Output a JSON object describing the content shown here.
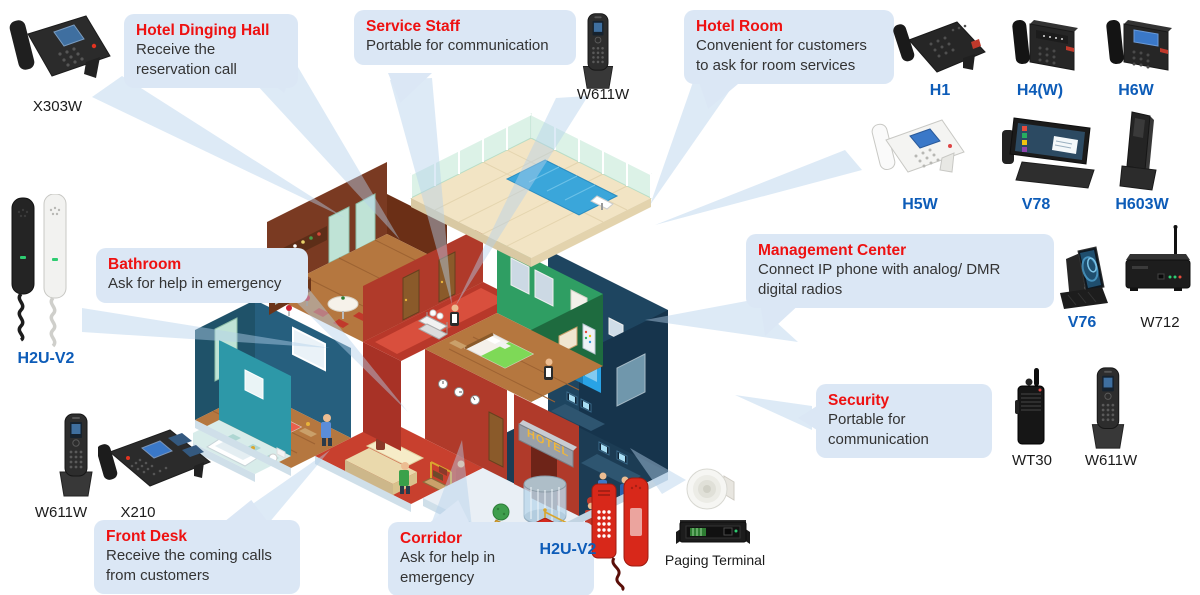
{
  "colors": {
    "callout_bg": "#dbe7f5",
    "title_red": "#ee1111",
    "label_blue": "#0d5cb8",
    "body_text": "#333333"
  },
  "building": {
    "sign": "HOTEL"
  },
  "callouts": {
    "dining_hall": {
      "title": "Hotel Dinging Hall",
      "line1": "Receive the",
      "line2": "reservation call"
    },
    "service_staff": {
      "title": "Service Staff",
      "line1": "Portable for communication"
    },
    "hotel_room": {
      "title": "Hotel Room",
      "line1": "Convenient for customers",
      "line2": "to ask for room services"
    },
    "bathroom": {
      "title": "Bathroom",
      "line1": "Ask for help in emergency"
    },
    "management_center": {
      "title": "Management Center",
      "line1": "Connect IP phone with analog/ DMR",
      "line2": "digital radios"
    },
    "security": {
      "title": "Security",
      "line1": "Portable for",
      "line2": "communication"
    },
    "front_desk": {
      "title": "Front Desk",
      "line1": "Receive the coming calls",
      "line2": "from customers"
    },
    "corridor": {
      "title": "Corridor",
      "line1": "Ask for help in",
      "line2": "emergency"
    }
  },
  "products": {
    "x303w": {
      "label": "X303W"
    },
    "w611w_service": {
      "label": "W611W"
    },
    "h1": {
      "label": "H1"
    },
    "h4w": {
      "label": "H4(W)"
    },
    "h6w": {
      "label": "H6W"
    },
    "h5w": {
      "label": "H5W"
    },
    "v78": {
      "label": "V78"
    },
    "h603w": {
      "label": "H603W"
    },
    "h2u_bathroom": {
      "label": "H2U-V2"
    },
    "v76": {
      "label": "V76"
    },
    "w712": {
      "label": "W712"
    },
    "wt30": {
      "label": "WT30"
    },
    "w611w_security": {
      "label": "W611W"
    },
    "w611w_frontdesk": {
      "label": "W611W"
    },
    "x210": {
      "label": "X210"
    },
    "h2u_corridor": {
      "label": "H2U-V2"
    },
    "paging_terminal": {
      "label": "Paging Terminal"
    }
  }
}
